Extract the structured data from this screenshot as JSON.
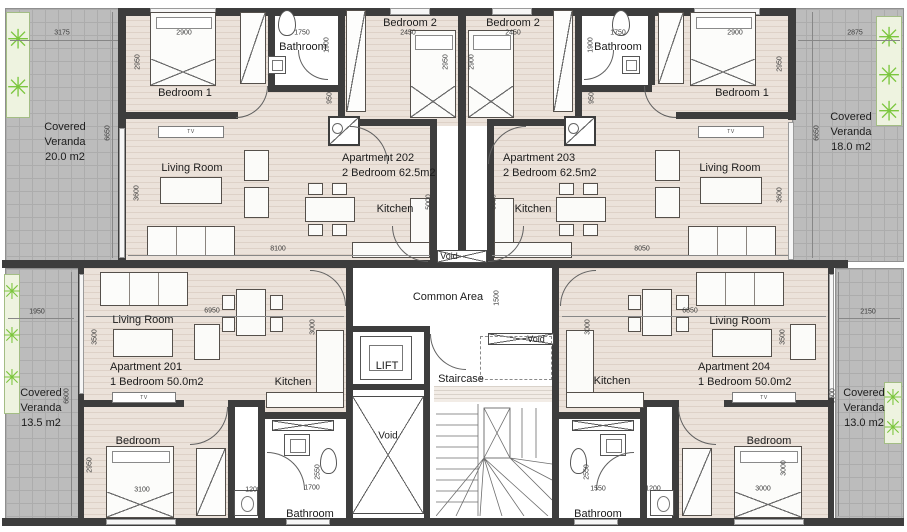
{
  "verandas": {
    "tl": {
      "l1": "Covered",
      "l2": "Veranda",
      "l3": "20.0 m2"
    },
    "tr": {
      "l1": "Covered",
      "l2": "Veranda",
      "l3": "18.0 m2"
    },
    "bl": {
      "l1": "Covered",
      "l2": "Veranda",
      "l3": "13.5 m2"
    },
    "br": {
      "l1": "Covered",
      "l2": "Veranda",
      "l3": "13.0 m2"
    }
  },
  "apartments": {
    "a202": {
      "name": "Apartment 202",
      "type": "2 Bedroom 62.5m2",
      "bedroom1": "Bedroom 1",
      "bedroom2": "Bedroom 2",
      "bathroom": "Bathroom",
      "living": "Living Room",
      "kitchen": "Kitchen",
      "tv": "TV"
    },
    "a203": {
      "name": "Apartment 203",
      "type": "2 Bedroom 62.5m2",
      "bedroom1": "Bedroom 1",
      "bedroom2": "Bedroom 2",
      "bathroom": "Bathroom",
      "living": "Living Room",
      "kitchen": "Kitchen",
      "tv": "TV"
    },
    "a201": {
      "name": "Apartment 201",
      "type": "1 Bedroom 50.0m2",
      "bedroom": "Bedroom",
      "bathroom": "Bathroom",
      "living": "Living Room",
      "kitchen": "Kitchen",
      "tv": "TV"
    },
    "a204": {
      "name": "Apartment 204",
      "type": "1 Bedroom 50.0m2",
      "bedroom": "Bedroom",
      "bathroom": "Bathroom",
      "living": "Living Room",
      "kitchen": "Kitchen",
      "tv": "TV"
    }
  },
  "core": {
    "common_area": "Common Area",
    "lift": "LIFT",
    "staircase": "Staircase",
    "void": "Void"
  },
  "dims": {
    "v_tl_w": "3175",
    "v_tl_h": "6650",
    "v_tr_w": "2875",
    "v_tr_h": "6650",
    "v_bl_w": "1950",
    "v_bl_h": "6600",
    "v_br_w": "2150",
    "v_br_h": "6600",
    "a202_bed1_w": "2900",
    "a202_bed1_h": "2950",
    "a202_bath_w": "1750",
    "a202_bath_h": "1900",
    "a202_hall": "950",
    "a202_bed2_w": "2450",
    "a202_bed2_h": "2950",
    "a202_living_w": "8100",
    "a202_living_h": "3600",
    "a202_kitchen_h": "5000",
    "a203_bed1_w": "2900",
    "a203_bed1_h": "2950",
    "a203_bath_w": "1750",
    "a203_bath_h": "1900",
    "a203_hall": "950",
    "a203_bed2_w": "2450",
    "a203_bed2_h": "2900",
    "a203_living_w": "8050",
    "a203_living_h": "3600",
    "a203_kitchen_h": "5000",
    "a201_living_w": "6950",
    "a201_living_h": "3500",
    "a201_kitchen_h": "3000",
    "a201_bed_w": "3100",
    "a201_bed_h": "2950",
    "a201_hall": "1200",
    "a201_bath_w": "1700",
    "a201_bath_h": "2550",
    "a204_living_w": "6850",
    "a204_living_h": "3500",
    "a204_kitchen_h": "3000",
    "a204_bed_w": "3000",
    "a204_bed_h": "3000",
    "a204_hall": "1200",
    "a204_bath_w": "1550",
    "a204_bath_h": "2550",
    "common_h": "1500"
  },
  "colors": {
    "wall": "#3d3d3d",
    "floor": "#ebe2da",
    "veranda": "#bcbcbc",
    "plant": "#7cc63e"
  }
}
